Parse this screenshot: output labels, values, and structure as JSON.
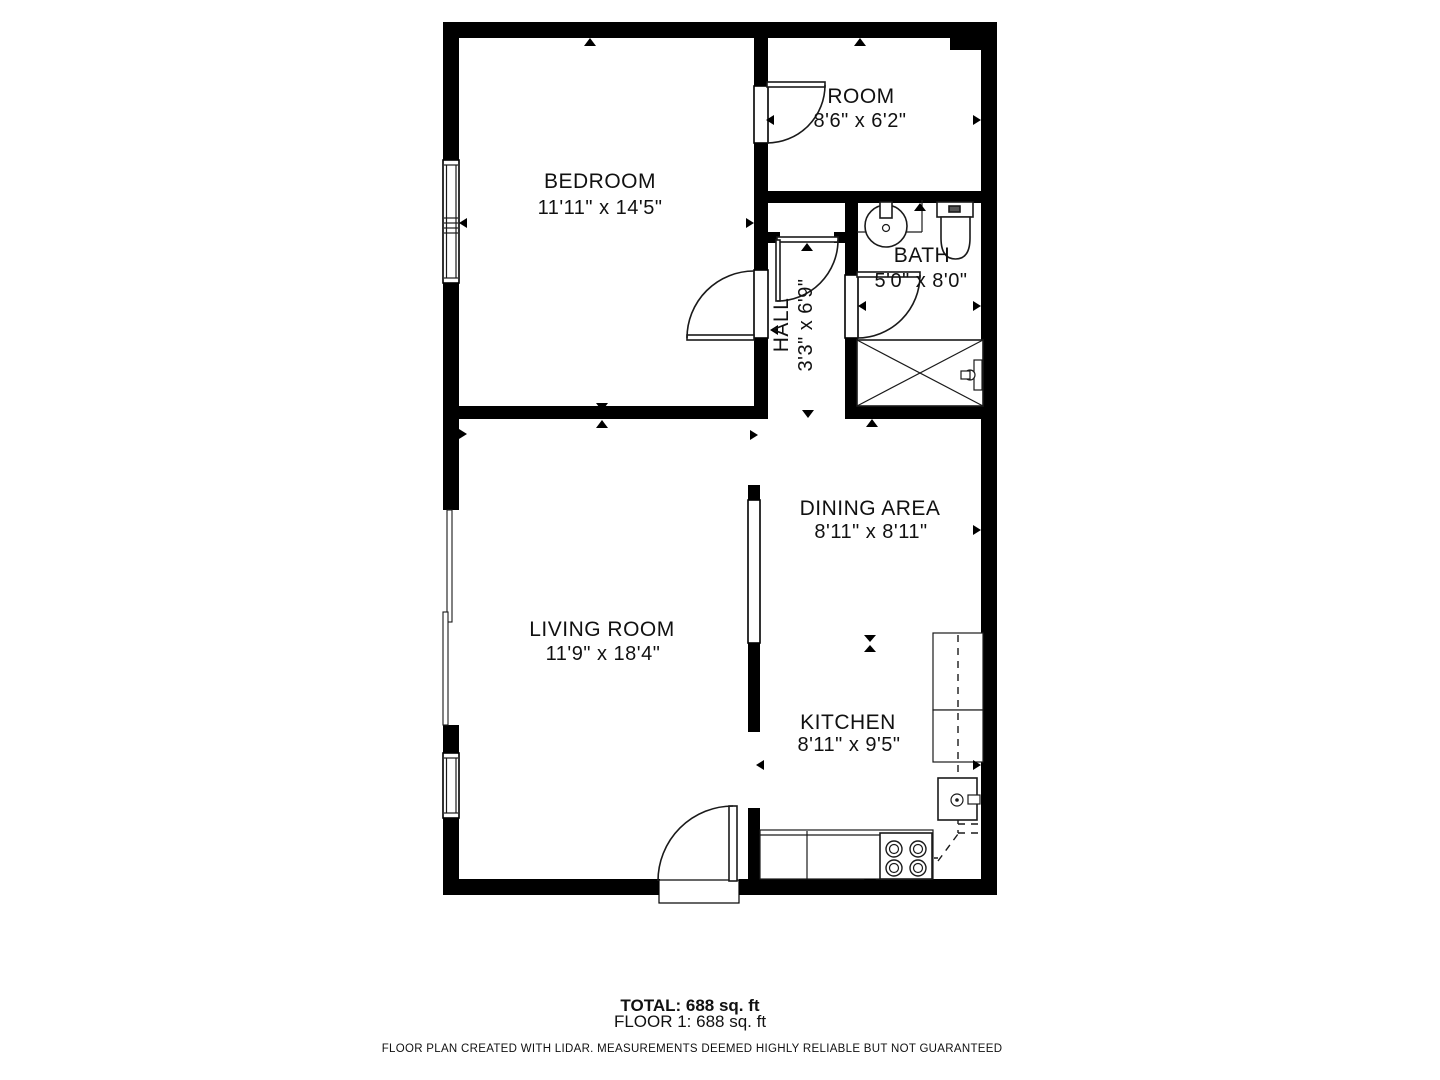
{
  "plan": {
    "rooms": {
      "bedroom": {
        "name": "BEDROOM",
        "dims": "11'11\" x 14'5\""
      },
      "room": {
        "name": "ROOM",
        "dims": "8'6\" x 6'2\""
      },
      "bath": {
        "name": "BATH",
        "dims": "5'0\" x 8'0\""
      },
      "hall": {
        "name": "HALL",
        "dims": "3'3\" x 6'9\""
      },
      "dining": {
        "name": "DINING AREA",
        "dims": "8'11\" x 8'11\""
      },
      "living": {
        "name": "LIVING ROOM",
        "dims": "11'9\" x 18'4\""
      },
      "kitchen": {
        "name": "KITCHEN",
        "dims": "8'11\" x 9'5\""
      }
    },
    "footer": {
      "total": "TOTAL: 688 sq. ft",
      "floor": "FLOOR 1: 688 sq. ft",
      "disclaimer": "FLOOR PLAN CREATED WITH LIDAR. MEASUREMENTS DEEMED HIGHLY RELIABLE BUT NOT GUARANTEED"
    },
    "colors": {
      "wall": "#000000",
      "background": "#ffffff"
    }
  }
}
